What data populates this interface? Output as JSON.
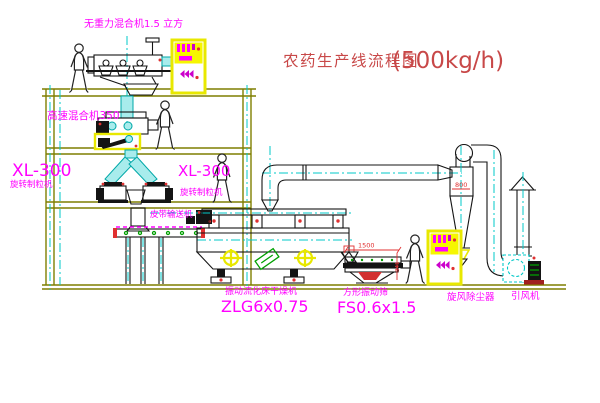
{
  "title": {
    "main": "农药生产线流程图",
    "capacity": "(500kg/h)"
  },
  "labels": {
    "top_mixer": "无重力混合机1.5 立方",
    "mid_mixer": "高速混合机350",
    "left_granulator_model": "XL-300",
    "left_granulator_name": "旋转制粒机",
    "center_granulator_model": "XL-300",
    "center_granulator_name": "旋转制粒机",
    "belt_conveyor": "皮带输送机",
    "dryer_name": "振动流化床干燥机",
    "dryer_model": "ZLG6x0.75",
    "sieve_name": "方形振动筛",
    "sieve_model": "FS0.6x1.5",
    "cyclone_name": "旋风除尘器",
    "fan_name": "引风机"
  },
  "dimensions": {
    "sieve_length": "1500",
    "sieve_height": "341",
    "cyclone_body": "800"
  },
  "colors": {
    "structure": "#7f7f00",
    "label_magenta": "#ff00ff",
    "title_red": "#c84848",
    "centerline_cyan": "#00c8c8",
    "equipment_black": "#141414",
    "cabinet_yellow": "#e8e800",
    "accent_red": "#e03030",
    "accent_green": "#00a000"
  }
}
